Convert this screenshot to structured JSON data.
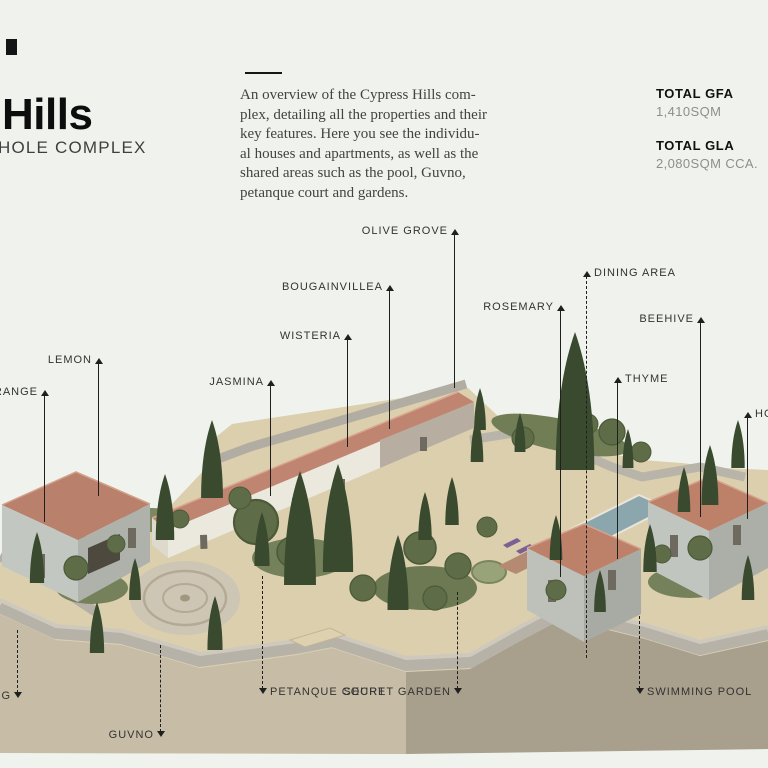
{
  "header": {
    "title": "Hills",
    "subtitle": "HOLE COMPLEX"
  },
  "intro": {
    "text": "An overview of the Cypress Hills com-\nplex, detailing all the properties and their\nkey features.  Here you see the individu-\nal houses and apartments, as well as the\nshared areas such as the pool, Guvno,\npetanque court and gardens."
  },
  "stats": [
    {
      "label": "TOTAL GFA",
      "value": "1,410SQM"
    },
    {
      "label": "TOTAL GLA",
      "value": "2,080SQM CCA."
    }
  ],
  "callouts": [
    {
      "label": "OLIVE GROVE",
      "line_x": 455,
      "label_y": 231,
      "text_side": "left",
      "line_top": 234,
      "line_bottom": 388,
      "dashed": false,
      "arrow": "up"
    },
    {
      "label": "BOUGAINVILLEA",
      "line_x": 390,
      "label_y": 287,
      "text_side": "left",
      "line_top": 290,
      "line_bottom": 429,
      "dashed": false,
      "arrow": "up"
    },
    {
      "label": "WISTERIA",
      "line_x": 348,
      "label_y": 336,
      "text_side": "left",
      "line_top": 339,
      "line_bottom": 447,
      "dashed": false,
      "arrow": "up"
    },
    {
      "label": "JASMINA",
      "line_x": 271,
      "label_y": 382,
      "text_side": "left",
      "line_top": 385,
      "line_bottom": 496,
      "dashed": false,
      "arrow": "up"
    },
    {
      "label": "LEMON",
      "line_x": 99,
      "label_y": 360,
      "text_side": "left",
      "line_top": 363,
      "line_bottom": 496,
      "dashed": false,
      "arrow": "up"
    },
    {
      "label": "ORANGE",
      "line_x": 45,
      "label_y": 392,
      "text_side": "left",
      "line_top": 395,
      "line_bottom": 522,
      "dashed": false,
      "arrow": "up"
    },
    {
      "label": "ROSEMARY",
      "line_x": 561,
      "label_y": 307,
      "text_side": "left",
      "line_top": 310,
      "line_bottom": 577,
      "dashed": false,
      "arrow": "up"
    },
    {
      "label": "DINING AREA",
      "line_x": 587,
      "label_y": 273,
      "text_side": "right",
      "line_top": 276,
      "line_bottom": 658,
      "dashed": true,
      "arrow": "up"
    },
    {
      "label": "BEEHIVE",
      "line_x": 701,
      "label_y": 319,
      "text_side": "left",
      "line_top": 322,
      "line_bottom": 517,
      "dashed": false,
      "arrow": "up"
    },
    {
      "label": "THYME",
      "line_x": 618,
      "label_y": 379,
      "text_side": "right",
      "line_top": 382,
      "line_bottom": 559,
      "dashed": false,
      "arrow": "up"
    },
    {
      "label": "HO",
      "line_x": 748,
      "label_y": 414,
      "text_side": "right",
      "line_top": 417,
      "line_bottom": 519,
      "dashed": false,
      "arrow": "up"
    },
    {
      "label": "NG",
      "line_x": 18,
      "label_y": 696,
      "text_side": "left",
      "line_top": 630,
      "line_bottom": 693,
      "dashed": true,
      "arrow": "down"
    },
    {
      "label": "GUVNO",
      "line_x": 161,
      "label_y": 735,
      "text_side": "left",
      "line_top": 645,
      "line_bottom": 732,
      "dashed": true,
      "arrow": "down"
    },
    {
      "label": "PETANQUE COURT",
      "line_x": 263,
      "label_y": 692,
      "text_side": "right",
      "line_top": 576,
      "line_bottom": 689,
      "dashed": true,
      "arrow": "down"
    },
    {
      "label": "SECRET GARDEN",
      "line_x": 458,
      "label_y": 692,
      "text_side": "left",
      "line_top": 592,
      "line_bottom": 689,
      "dashed": true,
      "arrow": "down"
    },
    {
      "label": "SWIMMING POOL",
      "line_x": 640,
      "label_y": 692,
      "text_side": "right",
      "line_top": 616,
      "line_bottom": 689,
      "dashed": true,
      "arrow": "down"
    }
  ],
  "palette": {
    "background": "#f0f3ed",
    "ink": "#111111",
    "label_ink": "#333333",
    "muted_value": "#8e8e8a",
    "roof_terracotta": "#bd8169",
    "stone_wall": "#b6b2a7",
    "house_wall_light": "#e9e6dc",
    "house_wall_stone": "#bcc0ba",
    "ground_path": "#dbcfae",
    "terrain_light": "#c7bca6",
    "terrain_dark": "#a99f8d",
    "garden_green": "#717d54",
    "cypress_green": "#3a4a2f",
    "pool_water": "#8ba6ad",
    "pool_deck": "#b58a73",
    "accent_purple": "#7d5f93"
  }
}
